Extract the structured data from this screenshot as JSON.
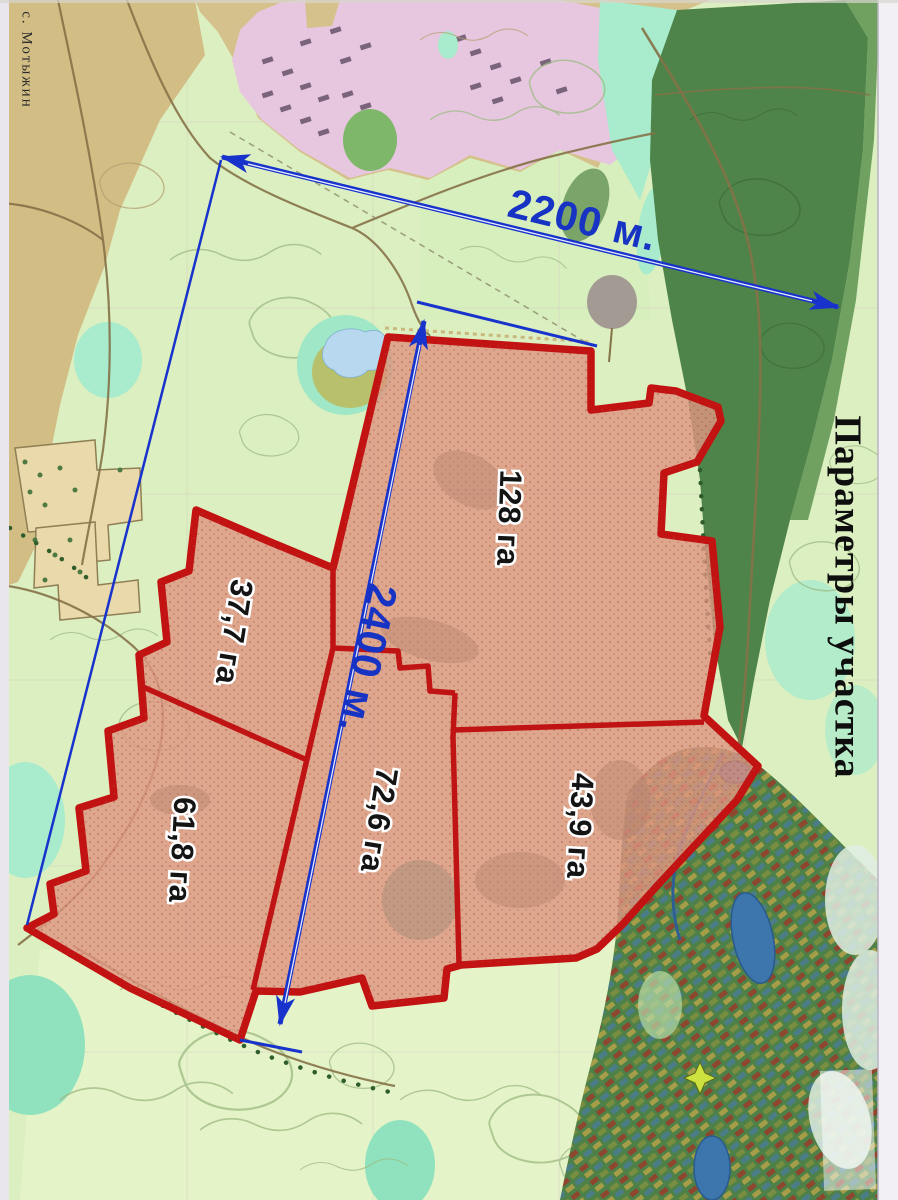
{
  "map": {
    "village_label": "с. Мотыжин",
    "title_vertical": "Параметры участка",
    "dimensions": {
      "width_label": "2200 м.",
      "height_label": "2400 м."
    },
    "parcels": [
      {
        "name": "parcel-128",
        "area": "128 га"
      },
      {
        "name": "parcel-37-7",
        "area": "37,7 га"
      },
      {
        "name": "parcel-61-8",
        "area": "61,8 га"
      },
      {
        "name": "parcel-72-6",
        "area": "72,6 га"
      },
      {
        "name": "parcel-43-9",
        "area": "43,9 га"
      }
    ],
    "colors": {
      "parcel_fill": "#de9681",
      "parcel_border": "#c21212",
      "dimension_blue": "#1733cc",
      "field_green": "#dcefc0",
      "forest_green": "#4e8449",
      "village_pink": "#e7c7df",
      "open_tan": "#d5c18b",
      "water_blue": "#b7d8ee",
      "mint": "#a8ebcd"
    }
  }
}
